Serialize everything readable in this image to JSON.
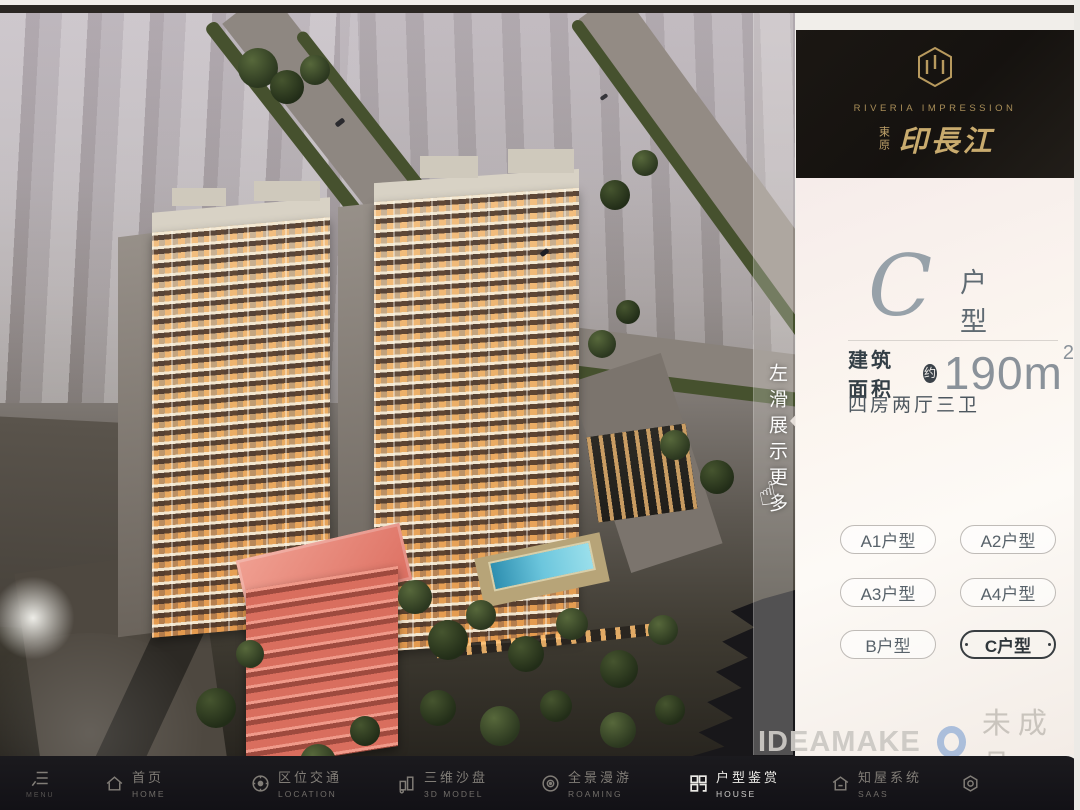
{
  "brand": {
    "logo_icon": "hexagon-monogram",
    "name_en": "RIVERIA IMPRESSION",
    "name_cn_prefix": "東原",
    "name_cn": "印長江"
  },
  "unit_panel": {
    "unit_letter": "C",
    "unit_type_label": "户型",
    "area_label": "建筑面积",
    "area_approx_badge": "约",
    "area_value": "190m",
    "area_exponent": "2",
    "rooms_text": "四房两厅三卫",
    "unit_buttons": [
      {
        "label": "A1户型",
        "selected": false
      },
      {
        "label": "A2户型",
        "selected": false
      },
      {
        "label": "A3户型",
        "selected": false
      },
      {
        "label": "A4户型",
        "selected": false
      },
      {
        "label": "B户型",
        "selected": false
      },
      {
        "label": "C户型",
        "selected": true
      }
    ]
  },
  "swipe_hint": {
    "text": "左滑展示更多",
    "hand_icon": "☝"
  },
  "watermark": {
    "brand": "IDEAMAKE",
    "label": "未成品"
  },
  "bottom_nav": {
    "items": [
      {
        "icon": "menu-icon",
        "label_cn": "",
        "label_en": "MENU",
        "active": false
      },
      {
        "icon": "home-icon",
        "label_cn": "首页",
        "label_en": "HOME",
        "active": false
      },
      {
        "icon": "location-icon",
        "label_cn": "区位交通",
        "label_en": "LOCATION",
        "active": false
      },
      {
        "icon": "3d-model-icon",
        "label_cn": "三维沙盘",
        "label_en": "3D MODEL",
        "active": false
      },
      {
        "icon": "roaming-icon",
        "label_cn": "全景漫游",
        "label_en": "ROAMING",
        "active": false
      },
      {
        "icon": "floorplan-icon",
        "label_cn": "户型鉴赏",
        "label_en": "HOUSE",
        "active": true
      },
      {
        "icon": "saas-icon",
        "label_cn": "知屋系统",
        "label_en": "SAAS",
        "active": false
      },
      {
        "icon": "gear-icon",
        "label_cn": "",
        "label_en": "",
        "active": false
      }
    ]
  },
  "colors": {
    "gold": "#b89a5e",
    "panel_bg": "#f8f1ec",
    "nav_bg": "#141318",
    "selected_border": "#33383c",
    "highlight_building": "#e0756a",
    "watermark_blue": "#5b8fc7"
  }
}
